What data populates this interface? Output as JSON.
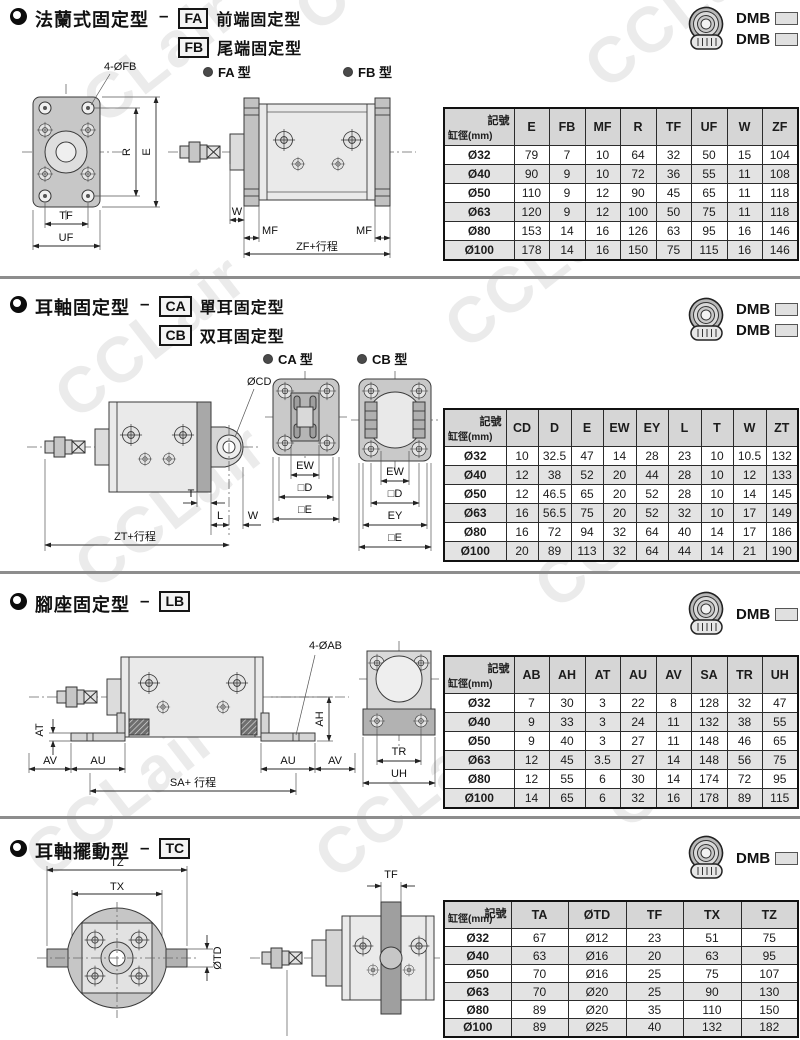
{
  "page": {
    "watermark_text": "CCLair"
  },
  "sections": [
    {
      "title": "法蘭式固定型",
      "dash": "–",
      "types": [
        {
          "code": "FA",
          "desc": "前端固定型"
        },
        {
          "code": "FB",
          "desc": "尾端固定型"
        }
      ],
      "models": [
        {
          "prefix": "DMB",
          "suffix": "FA"
        },
        {
          "prefix": "DMB",
          "suffix": "FB"
        }
      ],
      "diagram": {
        "labels": {
          "view_a": "FA 型",
          "view_b": "FB 型",
          "callout": "4-ØFB",
          "r": "R",
          "e": "E",
          "tf": "TF",
          "uf": "UF",
          "w": "W",
          "mf1": "MF",
          "mf2": "MF",
          "span": "ZF+行程"
        }
      },
      "table": {
        "corner_top": "記號",
        "corner_bottom": "缸徑(mm)",
        "headers": [
          "E",
          "FB",
          "MF",
          "R",
          "TF",
          "UF",
          "W",
          "ZF"
        ],
        "rows": [
          {
            "bore": "Ø32",
            "values": [
              "79",
              "7",
              "10",
              "64",
              "32",
              "50",
              "15",
              "104"
            ]
          },
          {
            "bore": "Ø40",
            "values": [
              "90",
              "9",
              "10",
              "72",
              "36",
              "55",
              "11",
              "108"
            ]
          },
          {
            "bore": "Ø50",
            "values": [
              "110",
              "9",
              "12",
              "90",
              "45",
              "65",
              "11",
              "118"
            ]
          },
          {
            "bore": "Ø63",
            "values": [
              "120",
              "9",
              "12",
              "100",
              "50",
              "75",
              "11",
              "118"
            ]
          },
          {
            "bore": "Ø80",
            "values": [
              "153",
              "14",
              "16",
              "126",
              "63",
              "95",
              "16",
              "146"
            ]
          },
          {
            "bore": "Ø100",
            "values": [
              "178",
              "14",
              "16",
              "150",
              "75",
              "115",
              "16",
              "146"
            ]
          }
        ]
      }
    },
    {
      "title": "耳軸固定型",
      "dash": "–",
      "types": [
        {
          "code": "CA",
          "desc": "單耳固定型"
        },
        {
          "code": "CB",
          "desc": "双耳固定型"
        }
      ],
      "models": [
        {
          "prefix": "DMB",
          "suffix": "CA"
        },
        {
          "prefix": "DMB",
          "suffix": "CB"
        }
      ],
      "diagram": {
        "labels": {
          "view_a": "CA 型",
          "view_b": "CB 型",
          "callout": "ØCD",
          "t": "T",
          "l": "L",
          "w": "W",
          "span": "ZT+行程",
          "ew1": "EW",
          "d1": "□D",
          "e1": "□E",
          "ew2": "EW",
          "d2": "□D",
          "ey": "EY",
          "e2": "□E"
        }
      },
      "table": {
        "corner_top": "記號",
        "corner_bottom": "缸徑(mm)",
        "headers": [
          "CD",
          "D",
          "E",
          "EW",
          "EY",
          "L",
          "T",
          "W",
          "ZT"
        ],
        "rows": [
          {
            "bore": "Ø32",
            "values": [
              "10",
              "32.5",
              "47",
              "14",
              "28",
              "23",
              "10",
              "10.5",
              "132"
            ]
          },
          {
            "bore": "Ø40",
            "values": [
              "12",
              "38",
              "52",
              "20",
              "44",
              "28",
              "10",
              "12",
              "133"
            ]
          },
          {
            "bore": "Ø50",
            "values": [
              "12",
              "46.5",
              "65",
              "20",
              "52",
              "28",
              "10",
              "14",
              "145"
            ]
          },
          {
            "bore": "Ø63",
            "values": [
              "16",
              "56.5",
              "75",
              "20",
              "52",
              "32",
              "10",
              "17",
              "149"
            ]
          },
          {
            "bore": "Ø80",
            "values": [
              "16",
              "72",
              "94",
              "32",
              "64",
              "40",
              "14",
              "17",
              "186"
            ]
          },
          {
            "bore": "Ø100",
            "values": [
              "20",
              "89",
              "113",
              "32",
              "64",
              "44",
              "14",
              "21",
              "190"
            ]
          }
        ]
      }
    },
    {
      "title": "腳座固定型",
      "dash": "–",
      "types": [
        {
          "code": "LB",
          "desc": ""
        }
      ],
      "models": [
        {
          "prefix": "DMB",
          "suffix": "LB"
        }
      ],
      "diagram": {
        "labels": {
          "callout": "4-ØAB",
          "at": "AT",
          "ah": "AH",
          "av1": "AV",
          "au1": "AU",
          "au2": "AU",
          "av2": "AV",
          "span": "SA+ 行程",
          "tr": "TR",
          "uh": "UH"
        }
      },
      "table": {
        "corner_top": "記號",
        "corner_bottom": "缸徑(mm)",
        "headers": [
          "AB",
          "AH",
          "AT",
          "AU",
          "AV",
          "SA",
          "TR",
          "UH"
        ],
        "rows": [
          {
            "bore": "Ø32",
            "values": [
              "7",
              "30",
              "3",
              "22",
              "8",
              "128",
              "32",
              "47"
            ]
          },
          {
            "bore": "Ø40",
            "values": [
              "9",
              "33",
              "3",
              "24",
              "11",
              "132",
              "38",
              "55"
            ]
          },
          {
            "bore": "Ø50",
            "values": [
              "9",
              "40",
              "3",
              "27",
              "11",
              "148",
              "46",
              "65"
            ]
          },
          {
            "bore": "Ø63",
            "values": [
              "12",
              "45",
              "3.5",
              "27",
              "14",
              "148",
              "56",
              "75"
            ]
          },
          {
            "bore": "Ø80",
            "values": [
              "12",
              "55",
              "6",
              "30",
              "14",
              "174",
              "72",
              "95"
            ]
          },
          {
            "bore": "Ø100",
            "values": [
              "14",
              "65",
              "6",
              "32",
              "16",
              "178",
              "89",
              "115"
            ]
          }
        ]
      }
    },
    {
      "title": "耳軸擺動型",
      "dash": "–",
      "types": [
        {
          "code": "TC",
          "desc": ""
        }
      ],
      "models": [
        {
          "prefix": "DMB",
          "suffix": "TC"
        }
      ],
      "diagram": {
        "labels": {
          "tz": "TZ",
          "tx": "TX",
          "otd": "ØTD",
          "tf": "TF"
        }
      },
      "table": {
        "corner_top": "記號",
        "corner_bottom": "缸徑(mm)",
        "headers": [
          "TA",
          "ØTD",
          "TF",
          "TX",
          "TZ"
        ],
        "rows": [
          {
            "bore": "Ø32",
            "values": [
              "67",
              "Ø12",
              "23",
              "51",
              "75"
            ]
          },
          {
            "bore": "Ø40",
            "values": [
              "63",
              "Ø16",
              "20",
              "63",
              "95"
            ]
          },
          {
            "bore": "Ø50",
            "values": [
              "70",
              "Ø16",
              "25",
              "75",
              "107"
            ]
          },
          {
            "bore": "Ø63",
            "values": [
              "70",
              "Ø20",
              "25",
              "90",
              "130"
            ]
          },
          {
            "bore": "Ø80",
            "values": [
              "89",
              "Ø20",
              "35",
              "110",
              "150"
            ]
          },
          {
            "bore": "Ø100",
            "values": [
              "89",
              "Ø25",
              "40",
              "132",
              "182"
            ]
          }
        ]
      }
    }
  ]
}
